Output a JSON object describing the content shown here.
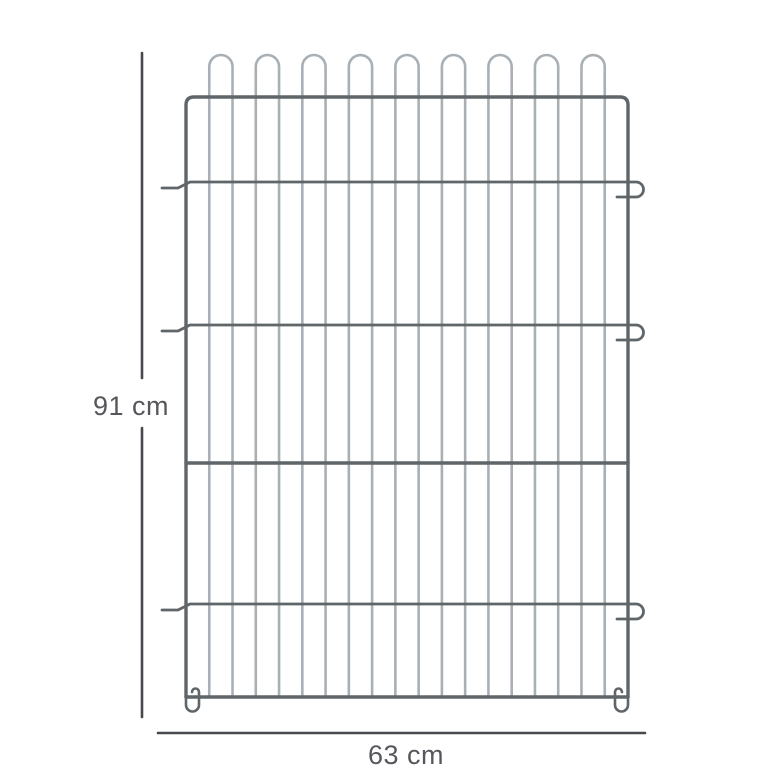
{
  "page": {
    "background": "#ffffff",
    "description": "Wire fence panel dimension diagram"
  },
  "diagram": {
    "panel": {
      "left": 186,
      "right": 628,
      "top_rail_y": 97,
      "bottom_rail_y": 697,
      "arch_count": 9,
      "arch_top_y": 55,
      "vertical_wire_count": 20,
      "hook_row_ys": [
        182,
        325,
        604
      ],
      "plain_row_y": 463,
      "hook_left_x": 162,
      "corner_radius": 8,
      "colors": {
        "frame": "#5f6569",
        "wire": "#a9b0b5"
      },
      "stroke": {
        "frame": 3.4,
        "wire": 2.6,
        "hook": 2.8
      }
    },
    "dimension_height": {
      "label": "91 cm",
      "line_x": 142,
      "y_start": 53,
      "y_end": 717,
      "gap_start": 378,
      "gap_end": 428,
      "label_x": 131,
      "label_y": 415
    },
    "dimension_width": {
      "label": "63 cm",
      "line_y": 733,
      "x_start": 158,
      "x_end": 645,
      "label_x": 406,
      "label_y": 764
    },
    "dimension_style": {
      "line_color": "#45484d",
      "line_width": 2.6,
      "text_color": "#55575c",
      "font_size": 27
    }
  }
}
